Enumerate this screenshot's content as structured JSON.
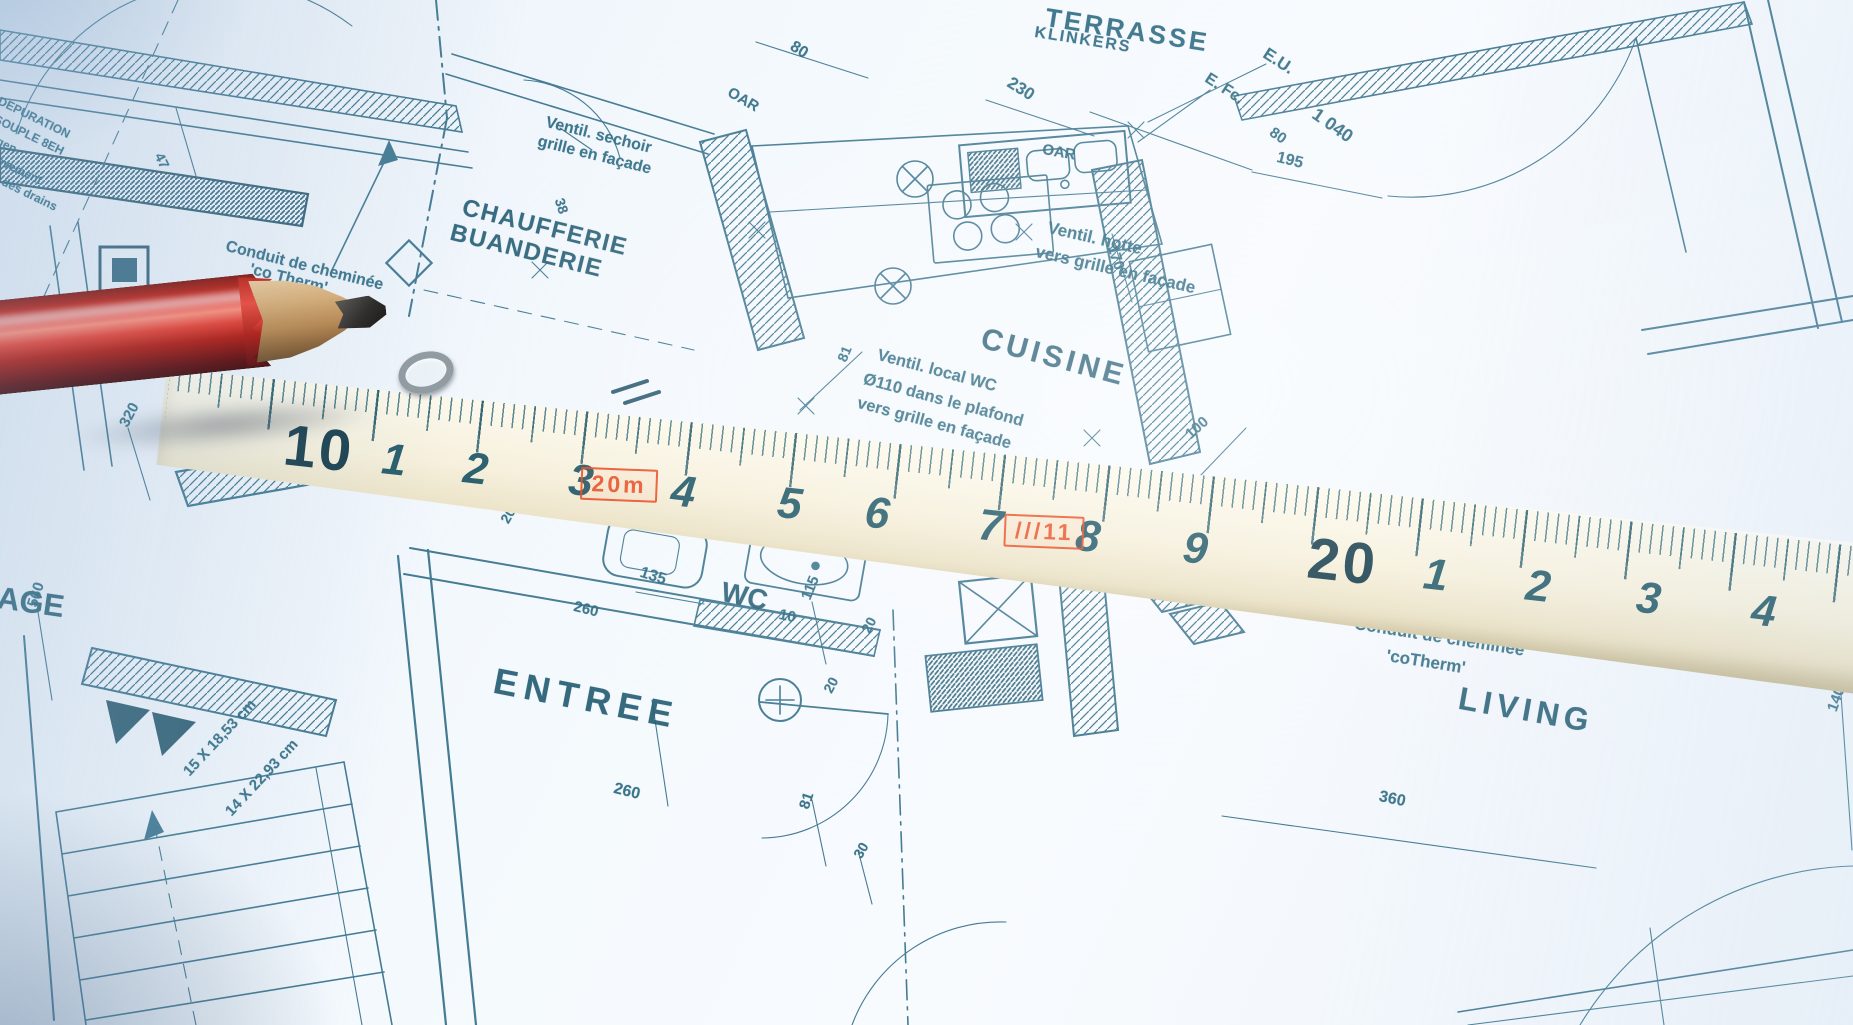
{
  "scene": {
    "subject": "architectural floor plan photographed with red pencil and tape measure",
    "colors": {
      "paper": "#f3f8fc",
      "ink": "#2c6a82",
      "ink_dark": "#27586c",
      "stamp_red": "#e8491f",
      "tape_body": "#f6f0dc",
      "pencil_red": "#bd1a0c"
    }
  },
  "blueprint": {
    "labels": [
      {
        "n": "terrasse",
        "t": "TERRASSE",
        "x": 1048,
        "y": 2,
        "r": 9,
        "s": 26,
        "w": 700,
        "ls": 3
      },
      {
        "n": "klinkers",
        "t": "KLINKERS",
        "x": 1036,
        "y": 24,
        "r": 9,
        "s": 16,
        "w": 700,
        "ls": 2
      },
      {
        "n": "dim-80-top",
        "t": "80",
        "x": 796,
        "y": 38,
        "r": 32,
        "s": 16
      },
      {
        "n": "oar-1",
        "t": "OAR",
        "x": 733,
        "y": 84,
        "r": 30,
        "s": 15
      },
      {
        "n": "dim-230",
        "t": "230",
        "x": 1014,
        "y": 73,
        "r": 32,
        "s": 17
      },
      {
        "n": "eu",
        "t": "E.U.",
        "x": 1270,
        "y": 44,
        "r": 33,
        "s": 17,
        "w": 700
      },
      {
        "n": "efc",
        "t": "E. Fc.",
        "x": 1211,
        "y": 70,
        "r": 33,
        "s": 16,
        "w": 700
      },
      {
        "n": "dim-1040",
        "t": "1 040",
        "x": 1320,
        "y": 104,
        "r": 35,
        "s": 18
      },
      {
        "n": "dim-80-right",
        "t": "80",
        "x": 1276,
        "y": 124,
        "r": 35,
        "s": 15
      },
      {
        "n": "dim-195",
        "t": "195",
        "x": 1279,
        "y": 149,
        "r": 14,
        "s": 16
      },
      {
        "n": "oar-2",
        "t": "OAR",
        "x": 1044,
        "y": 141,
        "r": 10,
        "s": 15
      },
      {
        "n": "ventil-sechoir-1",
        "t": "Ventil. sechoir",
        "x": 548,
        "y": 114,
        "r": 14,
        "s": 16
      },
      {
        "n": "ventil-sechoir-2",
        "t": "grille en façade",
        "x": 540,
        "y": 133,
        "r": 14,
        "s": 16
      },
      {
        "n": "chaufferie",
        "t": "CHAUFFERIE",
        "x": 466,
        "y": 194,
        "r": 14,
        "s": 24,
        "w": 700,
        "ls": 1.5,
        "c": "#265e75"
      },
      {
        "n": "buanderie",
        "t": "BUANDERIE",
        "x": 454,
        "y": 219,
        "r": 14,
        "s": 24,
        "w": 700,
        "ls": 1.5,
        "c": "#265e75"
      },
      {
        "n": "dim-38",
        "t": "38",
        "x": 567,
        "y": 196,
        "r": 72,
        "s": 14
      },
      {
        "n": "conduit-left-1",
        "t": "Conduit de cheminée",
        "x": 228,
        "y": 238,
        "r": 14,
        "s": 16
      },
      {
        "n": "conduit-left-2",
        "t": "'co Therm'",
        "x": 252,
        "y": 261,
        "r": 14,
        "s": 16
      },
      {
        "n": "dim-47",
        "t": "47",
        "x": 166,
        "y": 150,
        "r": 64,
        "s": 14
      },
      {
        "n": "frag-depuration",
        "t": "DEPURATION",
        "x": 2,
        "y": 94,
        "r": 26,
        "s": 12
      },
      {
        "n": "frag-souple",
        "t": "SOUPLE 8EH",
        "x": -2,
        "y": 112,
        "r": 26,
        "s": 12
      },
      {
        "n": "frag-gen",
        "t": "gen",
        "x": 0,
        "y": 134,
        "r": 26,
        "s": 12
      },
      {
        "n": "frag-hevement",
        "t": "hevement",
        "x": -6,
        "y": 150,
        "r": 26,
        "s": 12
      },
      {
        "n": "frag-drains",
        "t": "n des drains",
        "x": -4,
        "y": 170,
        "r": 26,
        "s": 12
      },
      {
        "n": "ventil-hotte-1",
        "t": "Ventil. hotte",
        "x": 1050,
        "y": 218,
        "r": 13,
        "s": 17
      },
      {
        "n": "ventil-hotte-2",
        "t": "vers grille en façade",
        "x": 1038,
        "y": 242,
        "r": 13,
        "s": 17
      },
      {
        "n": "cuisine",
        "t": "CUISINE",
        "x": 986,
        "y": 322,
        "r": 15,
        "s": 30,
        "w": 700,
        "ls": 4,
        "c": "#265e75"
      },
      {
        "n": "dim-170",
        "t": "170",
        "x": 1120,
        "y": 243,
        "r": 72,
        "s": 15
      },
      {
        "n": "ventil-wc-1",
        "t": "Ventil. local WC",
        "x": 880,
        "y": 346,
        "r": 15,
        "s": 16.5
      },
      {
        "n": "ventil-wc-2",
        "t": "Ø110 dans le plafond",
        "x": 866,
        "y": 370,
        "r": 15,
        "s": 16.5
      },
      {
        "n": "ventil-wc-3",
        "t": "vers grille en façade",
        "x": 860,
        "y": 394,
        "r": 15,
        "s": 16.5
      },
      {
        "n": "dim-81-mid",
        "t": "81",
        "x": 834,
        "y": 358,
        "r": -68,
        "s": 14
      },
      {
        "n": "dim-100",
        "t": "100",
        "x": 1182,
        "y": 430,
        "r": -42,
        "s": 15
      },
      {
        "n": "dim-20-a",
        "t": "20",
        "x": 497,
        "y": 518,
        "r": -60,
        "s": 14
      },
      {
        "n": "dim-135",
        "t": "135",
        "x": 643,
        "y": 564,
        "r": 18,
        "s": 16
      },
      {
        "n": "wc",
        "t": "WC",
        "x": 725,
        "y": 576,
        "r": 12,
        "s": 28,
        "w": 700,
        "c": "#265e75"
      },
      {
        "n": "wc-10",
        "t": "10",
        "x": 781,
        "y": 606,
        "r": 12,
        "s": 15,
        "w": 700
      },
      {
        "n": "dim-115",
        "t": "115",
        "x": 798,
        "y": 596,
        "r": -68,
        "s": 15
      },
      {
        "n": "dim-20-b",
        "t": "20",
        "x": 858,
        "y": 628,
        "r": -62,
        "s": 14
      },
      {
        "n": "dim-20-c",
        "t": "20",
        "x": 820,
        "y": 688,
        "r": -62,
        "s": 14
      },
      {
        "n": "dim-260-a",
        "t": "260",
        "x": 576,
        "y": 598,
        "r": 14,
        "s": 15
      },
      {
        "n": "entree",
        "t": "ENTREE",
        "x": 498,
        "y": 660,
        "r": 11,
        "s": 36,
        "w": 700,
        "ls": 7,
        "c": "#265e75"
      },
      {
        "n": "dim-260-b",
        "t": "260",
        "x": 616,
        "y": 780,
        "r": 14,
        "s": 16
      },
      {
        "n": "dim-81-b",
        "t": "81",
        "x": 796,
        "y": 806,
        "r": -72,
        "s": 15
      },
      {
        "n": "dim-30",
        "t": "30",
        "x": 850,
        "y": 853,
        "r": -60,
        "s": 14
      },
      {
        "n": "stair-dim-1",
        "t": "15 X 18,53 cm",
        "x": 180,
        "y": 768,
        "r": -47,
        "s": 15
      },
      {
        "n": "stair-dim-2",
        "t": "14 X 22,93 cm",
        "x": 222,
        "y": 808,
        "r": -47,
        "s": 15
      },
      {
        "n": "age",
        "t": "AGE",
        "x": 0,
        "y": 580,
        "r": 8,
        "s": 31,
        "w": 700,
        "c": "#265e75"
      },
      {
        "n": "dim-560",
        "t": "560",
        "x": 24,
        "y": 604,
        "r": -72,
        "s": 15
      },
      {
        "n": "dim-320",
        "t": "320",
        "x": 116,
        "y": 422,
        "r": -62,
        "s": 15
      },
      {
        "n": "conduit-right-1",
        "t": "Conduit de cheminée",
        "x": 1356,
        "y": 614,
        "r": 9,
        "s": 17
      },
      {
        "n": "conduit-right-2",
        "t": "'coTherm'",
        "x": 1388,
        "y": 646,
        "r": 9,
        "s": 17
      },
      {
        "n": "living",
        "t": "LIVING",
        "x": 1462,
        "y": 680,
        "r": 10,
        "s": 32,
        "w": 700,
        "ls": 5,
        "c": "#265e75"
      },
      {
        "n": "dim-360",
        "t": "360",
        "x": 1381,
        "y": 788,
        "r": 12,
        "s": 16
      },
      {
        "n": "dim-140",
        "t": "140",
        "x": 1824,
        "y": 708,
        "r": -70,
        "s": 15
      }
    ]
  },
  "tape": {
    "numbers": [
      {
        "t": "10",
        "x": 125,
        "bold": true
      },
      {
        "t": "1",
        "x": 224
      },
      {
        "t": "2",
        "x": 306
      },
      {
        "t": "3",
        "x": 412
      },
      {
        "t": "4",
        "x": 515
      },
      {
        "t": "5",
        "x": 622
      },
      {
        "t": "6",
        "x": 710
      },
      {
        "t": "7",
        "x": 824
      },
      {
        "t": "8",
        "x": 922
      },
      {
        "t": "9",
        "x": 1030
      },
      {
        "t": "20",
        "x": 1155,
        "bold": true
      },
      {
        "t": "1",
        "x": 1272
      },
      {
        "t": "2",
        "x": 1375
      },
      {
        "t": "3",
        "x": 1486
      },
      {
        "t": "4",
        "x": 1602
      }
    ],
    "stamps": [
      {
        "n": "stamp-20m",
        "t": "20m",
        "x": 424,
        "y": 62
      },
      {
        "n": "stamp-111",
        "t": "///11",
        "x": 850,
        "y": 62
      }
    ]
  }
}
